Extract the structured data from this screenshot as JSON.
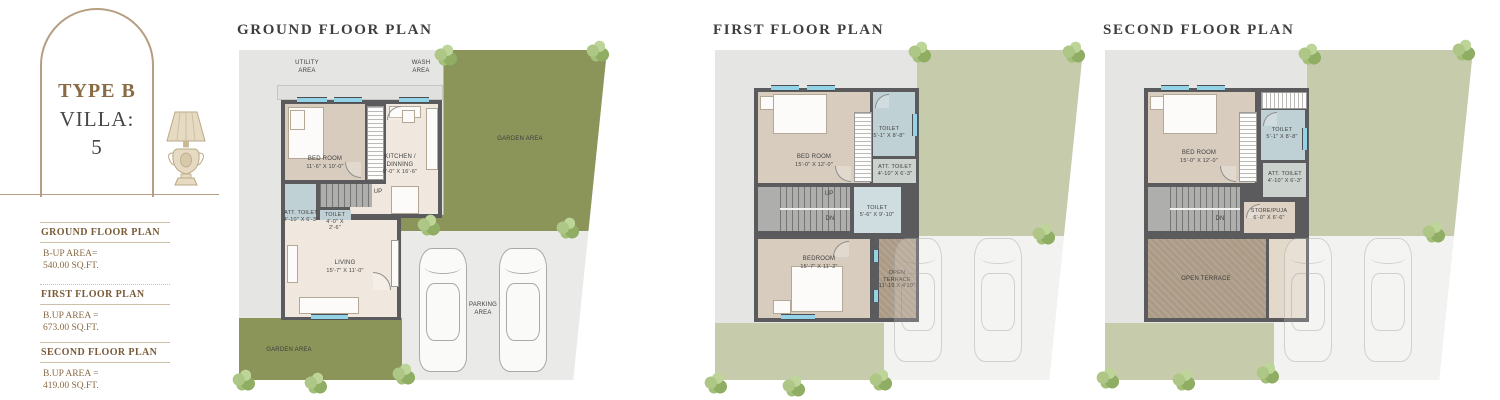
{
  "sidebar": {
    "type_title": "TYPE B",
    "villa_line1": "VILLA:",
    "villa_line2": "5",
    "specs": [
      {
        "title": "GROUND FLOOR PLAN",
        "line1": "B-UP AREA=",
        "line2": "540.00 SQ.FT."
      },
      {
        "title": "FIRST FLOOR PLAN",
        "line1": "B.UP AREA =",
        "line2": "673.00 SQ.FT."
      },
      {
        "title": "SECOND FLOOR PLAN",
        "line1": "B.UP AREA =",
        "line2": "419.00 SQ.FT."
      }
    ]
  },
  "ground": {
    "title": "GROUND FLOOR PLAN",
    "utility1": "UTILITY",
    "utility2": "AREA",
    "wash1": "WASH",
    "wash2": "AREA",
    "garden_top": "GARDEN AREA",
    "garden_bottom": "GARDEN AREA",
    "parking1": "PARKING",
    "parking2": "AREA",
    "up": "UP",
    "bedroom_name": "BED ROOM",
    "bedroom_dims": "11'-6\" X 10'-0\"",
    "kitchen_name": "KITCHEN / DINNING",
    "kitchen_dims": "9'-0\" X 16'-6\"",
    "att_toilet_name": "ATT. TOILET",
    "att_toilet_dims": "4'-10\" X 6'-3\"",
    "toilet_name": "TOILET",
    "toilet_dims1": "4'-0\" X",
    "toilet_dims2": "2'-6\"",
    "living_name": "LIVING",
    "living_dims": "15'-7\" X 11'-0\""
  },
  "first": {
    "title": "FIRST FLOOR PLAN",
    "bedroom1_name": "BED ROOM",
    "bedroom1_dims": "15'-0\" X 12'-0\"",
    "toilet1_name": "TOILET",
    "toilet1_dims": "5'-1\" X 8'-8\"",
    "att_toilet_name": "ATT. TOILET",
    "att_toilet_dims": "4'-10\" X 6'-3\"",
    "toilet2_name": "TOILET",
    "toilet2_dims": "5'-6\" X 9'-10\"",
    "bedroom2_name": "BEDROOM",
    "bedroom2_dims": "15'-7\" X 11'-2\"",
    "terrace1": "OPEN",
    "terrace2": "TERRACE",
    "terrace3": "11'-10 X 4'10\"",
    "up": "UP",
    "dn": "DN"
  },
  "second": {
    "title": "SECOND FLOOR PLAN",
    "bedroom_name": "BED ROOM",
    "bedroom_dims": "15'-0\" X 12'-0\"",
    "toilet_name": "TOILET",
    "toilet_dims": "5'-1\" X 8'-8\"",
    "att_toilet_name": "ATT. TOILET",
    "att_toilet_dims": "4'-10\" X 6'-3\"",
    "store_name": "STORE/PUJA",
    "store_dims": "6'-0\" X 6'-6\"",
    "terrace": "OPEN TERRACE",
    "dn": "DN"
  },
  "colors": {
    "garden_green": "#8b9459",
    "garden_pale": "#c6cbac",
    "plot_gray": "#e5e5e4",
    "wall_gray": "#5b5b5e",
    "room_tan": "#d8ccbe",
    "room_cream": "#f0e8df",
    "toilet_blue": "#c0d1d5",
    "terrace_brown": "#ab9a86",
    "window_blue": "#92d3e8",
    "accent_brown": "#8a6b45",
    "heading_brown": "#7a5a38",
    "title_gray": "#3e3e3e",
    "arch_border": "#b59e81"
  }
}
